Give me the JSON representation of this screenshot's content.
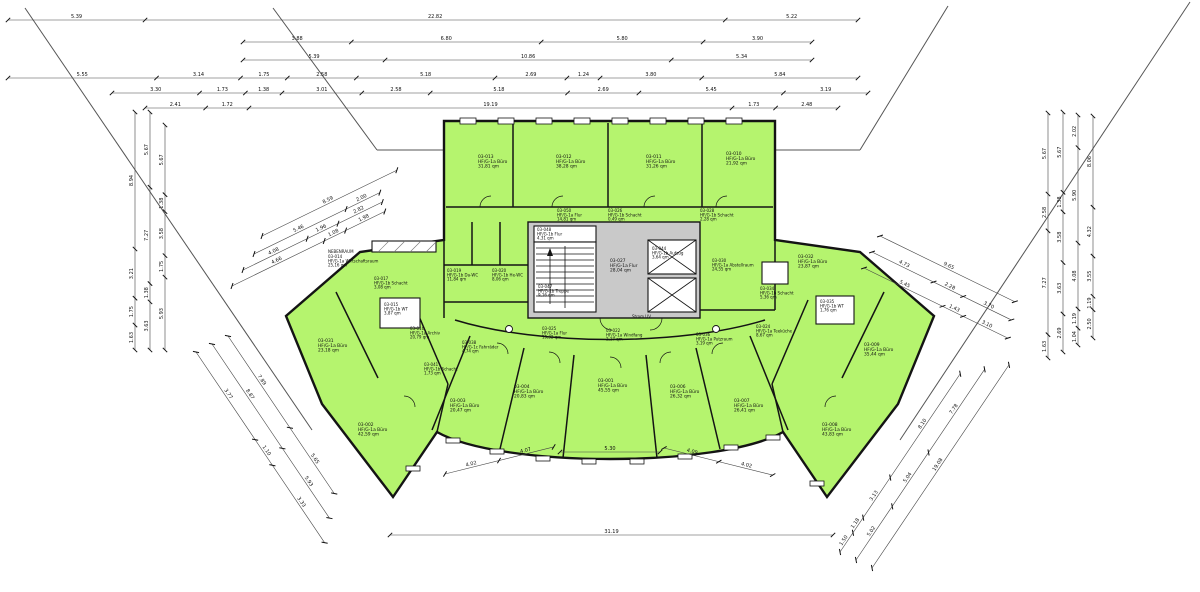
{
  "colors": {
    "room_fill": "#b5f46e",
    "core_fill": "#c9c9c9",
    "wall": "#141414",
    "dim_line": "#444444"
  },
  "labels": {
    "nebenraum": "NEBENRAUM",
    "strom_uv": "Strom UV"
  },
  "rooms": {
    "r013": {
      "code": "03-013",
      "type": "HF/G-1a Büro",
      "area": "31,81 qm"
    },
    "r012": {
      "code": "03-012",
      "type": "HF/G-1a Büro",
      "area": "38,28 qm"
    },
    "r011": {
      "code": "03-011",
      "type": "HF/G-1a Büro",
      "area": "31,26 qm"
    },
    "r010": {
      "code": "03-010",
      "type": "HF/G-1a Büro",
      "area": "21,92 qm"
    },
    "r050": {
      "code": "03-050",
      "type": "HF/G-1a Flur",
      "area": "14,81 qm"
    },
    "r026": {
      "code": "03-026",
      "type": "HF/G-1b Schacht",
      "area": "0,49 qm"
    },
    "r028": {
      "code": "03-028",
      "type": "HF/G-1b Schacht",
      "area": "2,28 qm"
    },
    "r048": {
      "code": "03-048",
      "type": "HF/G-1b Flur",
      "area": "4,31 qm"
    },
    "r047": {
      "code": "03-047",
      "type": "HF/G-1b Treppe",
      "area": "9,16 qm"
    },
    "r027": {
      "code": "03-027",
      "type": "HF/G-1a Flur",
      "area": "28,04 qm"
    },
    "r044": {
      "code": "03-044",
      "type": "HF/G-1b Aufzug",
      "area": "3,64 qm"
    },
    "r019": {
      "code": "03-019",
      "type": "HF/G-1b Da-WC",
      "area": "11,84 qm"
    },
    "r020": {
      "code": "03-020",
      "type": "HF/G-1b He-WC",
      "area": "8,06 qm"
    },
    "r014": {
      "code": "03-014",
      "type": "HF/G-1a Wirtschaftsraum",
      "area": "25,16 qm"
    },
    "r017": {
      "code": "03-017",
      "type": "HF/G-1b Schacht",
      "area": "3,08 qm"
    },
    "r015": {
      "code": "03-015",
      "type": "HF/G-1b WT",
      "area": "3,87 qm"
    },
    "r016": {
      "code": "03-016",
      "type": "HF/G-1a Archiv",
      "area": "20,79 qm"
    },
    "r041": {
      "code": "03-041",
      "type": "HF/G-1b Schacht",
      "area": "1,73 qm"
    },
    "r038": {
      "code": "03-038",
      "type": "HF/G-1c Fahrräder",
      "area": "4,74 qm"
    },
    "r031": {
      "code": "03-031",
      "type": "HF/G-1a Büro",
      "area": "23,18 qm"
    },
    "r002": {
      "code": "03-002",
      "type": "HF/G-1a Büro",
      "area": "42,59 qm"
    },
    "r003": {
      "code": "03-003",
      "type": "HF/G-1a Büro",
      "area": "20,47 qm"
    },
    "r004": {
      "code": "03-004",
      "type": "HF/G-1a Büro",
      "area": "20,83 qm"
    },
    "r001": {
      "code": "03-001",
      "type": "HF/G-1a Büro",
      "area": "45,55 qm"
    },
    "r006": {
      "code": "03-006",
      "type": "HF/G-1a Büro",
      "area": "26,32 qm"
    },
    "r007": {
      "code": "03-007",
      "type": "HF/G-1a Büro",
      "area": "26,41 qm"
    },
    "r008": {
      "code": "03-008",
      "type": "HF/G-1a Büro",
      "area": "43,83 qm"
    },
    "r009": {
      "code": "03-009",
      "type": "HF/G-1a Büro",
      "area": "35,44 qm"
    },
    "r030": {
      "code": "03-030",
      "type": "HF/G-1a Abstellraum",
      "area": "24,55 qm"
    },
    "r032": {
      "code": "03-032",
      "type": "HF/G-1a Büro",
      "area": "23,87 qm"
    },
    "r034": {
      "code": "03-034",
      "type": "HF/G-1b Schacht",
      "area": "5,36 qm"
    },
    "r035": {
      "code": "03-035",
      "type": "HF/G-1b WT",
      "area": "1,76 qm"
    },
    "r024": {
      "code": "03-024",
      "type": "HF/G-1a Teeküche",
      "area": "8,67 qm"
    },
    "r036": {
      "code": "03-036",
      "type": "HF/G-1a Putzraum",
      "area": "3,19 qm"
    },
    "r025": {
      "code": "03-025",
      "type": "HF/G-1a Flur",
      "area": "19,32 qm"
    },
    "r022": {
      "code": "03-022",
      "type": "HF/G-1a Windfang",
      "area": "2,17 qm"
    }
  },
  "dims": {
    "top1": [
      "5.39",
      "22.82",
      "5.22"
    ],
    "top2": [
      "3.88",
      "6.80",
      "5.80",
      "3.90"
    ],
    "top3": [
      "5.39",
      "10.86",
      "5.34"
    ],
    "top4": [
      "5.55",
      "3.14",
      "1.75",
      "2.58",
      "5.18",
      "2.69",
      "1.24",
      "3.80",
      "5.84"
    ],
    "top5": [
      "3.30",
      "1.73",
      "1.38",
      "3.01",
      "2.58",
      "5.18",
      "2.69",
      "5.45",
      "3.19"
    ],
    "top6": [
      "2.41",
      "1.72",
      "19.19",
      "1.73",
      "2.48"
    ],
    "l1": [
      "1.63",
      "1.75",
      "3.21",
      "8.94"
    ],
    "l2": [
      "3.63",
      "1.38",
      "7.27",
      "5.67"
    ],
    "l3": [
      "5.93",
      "1.75",
      "3.58",
      "1.38",
      "5.67"
    ],
    "r1": [
      "1.63",
      "7.27",
      "2.58",
      "5.67"
    ],
    "r2": [
      "2.69",
      "3.63",
      "3.58",
      "1.38",
      "5.67"
    ],
    "r3": [
      "1.04",
      "1.19",
      "4.08",
      "5.90",
      "2.02"
    ],
    "r4": [
      "2.50",
      "1.19",
      "3.55",
      "4.32",
      "8.06"
    ],
    "dl1": [
      "4.66",
      "1.08",
      "1.98"
    ],
    "dl2": [
      "4.08",
      "1.96",
      "2.82"
    ],
    "dl3": [
      "5.46",
      "2.00"
    ],
    "dl4": [
      "8.59"
    ],
    "drt1": [
      "9.65"
    ],
    "drt2": [
      "4.73",
      "2.28",
      "3.70"
    ],
    "drt3": [
      "5.45",
      "1.43",
      "3.10"
    ],
    "dbl1": [
      "3.77",
      "1.10",
      "3.33"
    ],
    "dbl2": [
      "8.87",
      "5.93"
    ],
    "dbl3": [
      "7.89",
      "5.65"
    ],
    "drb1": [
      "1.50",
      "1.18",
      "3.13",
      "8.10"
    ],
    "drb2": [
      "5.02",
      "5.04",
      "7.78"
    ],
    "drb3": [
      "19.08"
    ],
    "bl": [
      "4.02",
      "4.07"
    ],
    "bc": [
      "5.30"
    ],
    "br": [
      "4.09",
      "4.02"
    ],
    "b31": [
      "31.19"
    ]
  }
}
